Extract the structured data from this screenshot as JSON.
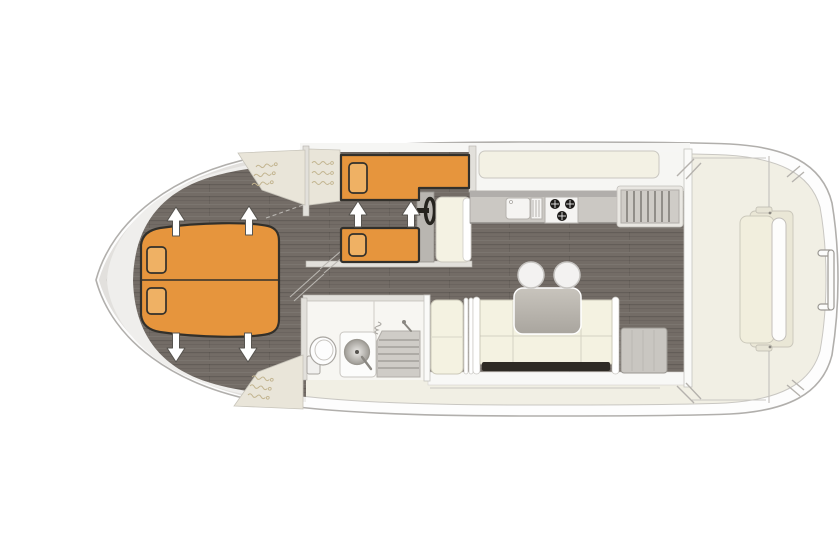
{
  "meta": {
    "title": "Boat floor plan — top view deck layout",
    "canvas": {
      "width": 840,
      "height": 560
    }
  },
  "colors": {
    "bed-orange": "#e6953d",
    "pillow-orange": "#efb164",
    "outline-dark": "#32302b",
    "floor-dark": "#736c66",
    "deck-cream": "#f1efe4",
    "hull-white": "#fdfdfd",
    "hull-line": "#b1afac",
    "wall-light": "#e2e0db",
    "wardrobe-beige": "#e9e5d9",
    "hanger-tan": "#c2b48f",
    "counter-gray": "#cbc8c3",
    "counter-dark": "#b1aeab",
    "sofa-cream": "#f4f2e1",
    "table-gray": "#b9b5ae",
    "black": "#1d1b19"
  },
  "plan": {
    "vessel": "motor-cruiser-top-view",
    "bow_cabin": {
      "double_berth": 1,
      "pillows": 2,
      "slide_arrows": [
        "up",
        "up",
        "down",
        "down"
      ],
      "wardrobes": 3
    },
    "mid_cabin": {
      "single_berths": 2,
      "pillows": 2,
      "slide_arrows": [
        "up",
        "up"
      ]
    },
    "helm": {
      "items": [
        "steering-wheel",
        "helm-seat"
      ]
    },
    "galley": {
      "items": [
        "counter",
        "sink",
        "drainboard",
        "stove-3-burner",
        "side-steps"
      ]
    },
    "bathroom": {
      "items": [
        "toilet",
        "washbasin",
        "faucet",
        "shower-steps",
        "door-handle",
        "door-spring"
      ]
    },
    "salon": {
      "items": [
        "chaise-seat",
        "sofa",
        "table",
        "stool",
        "stool",
        "side-table"
      ]
    },
    "aft_deck": {
      "items": [
        "bench-seat",
        "backrest-roll",
        "transom-handle",
        "corner-trims"
      ]
    }
  }
}
